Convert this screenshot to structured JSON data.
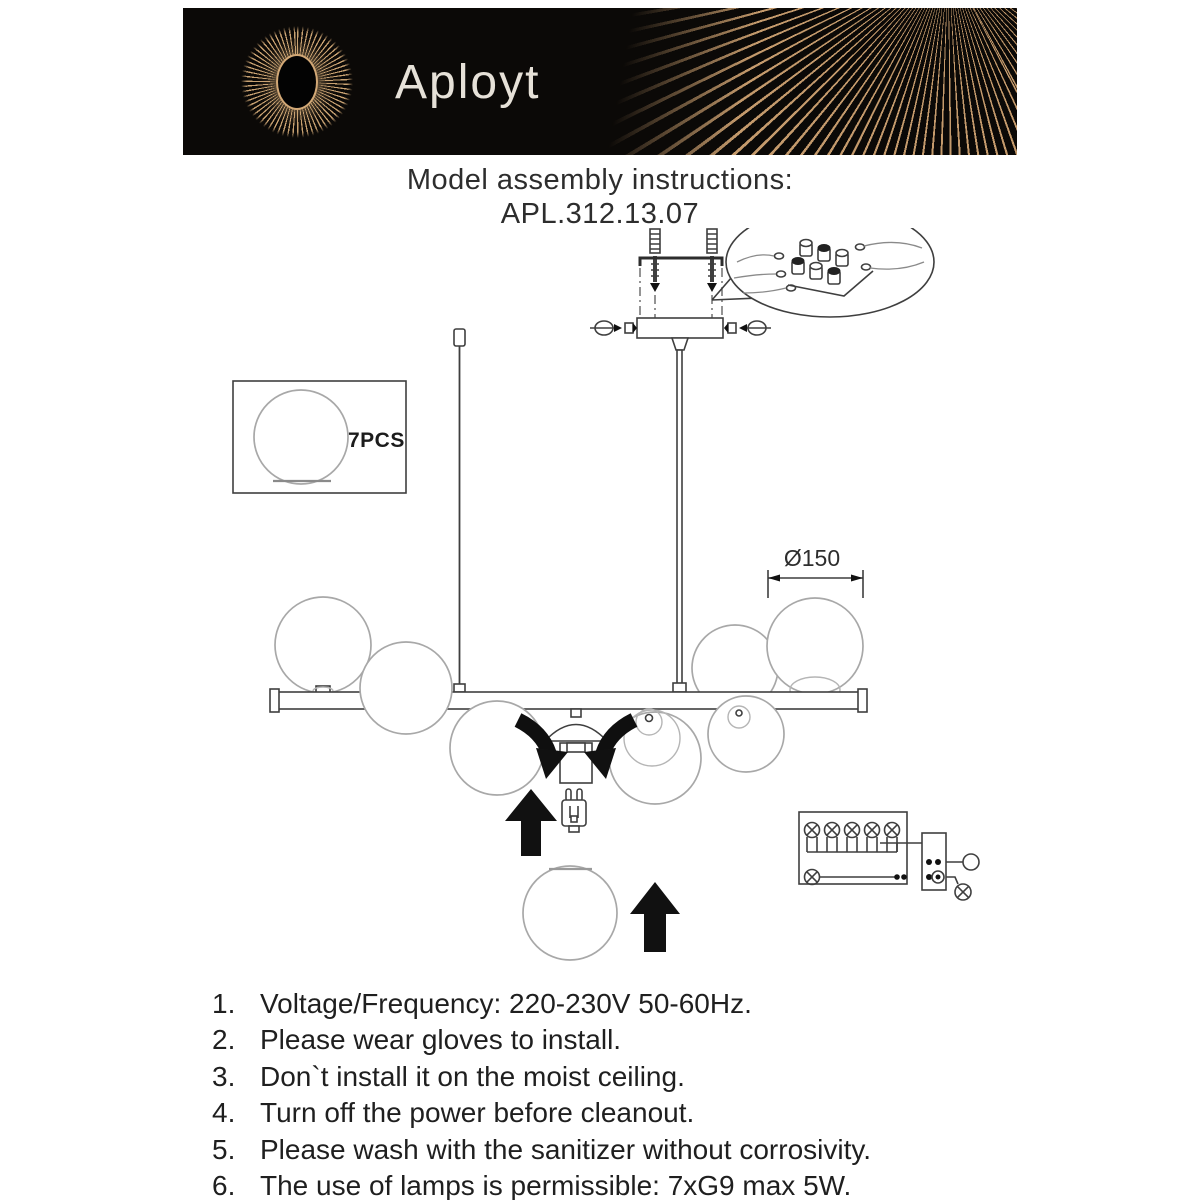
{
  "brand": {
    "name": "Aployt"
  },
  "title": {
    "heading": "Model assembly instructions:",
    "model": "APL.312.13.07"
  },
  "diagram": {
    "parts_box": {
      "label": "7PCS"
    },
    "dimension": {
      "label": "Ø150"
    }
  },
  "instructions": {
    "items": [
      {
        "num": "1.",
        "text": "Voltage/Frequency: 220-230V 50-60Hz."
      },
      {
        "num": "2.",
        "text": "Please wear gloves to install."
      },
      {
        "num": "3.",
        "text": "Don`t install it on the moist ceiling."
      },
      {
        "num": "4.",
        "text": "Turn off the power before cleanout."
      },
      {
        "num": "5.",
        "text": "Please wash with the sanitizer without corrosivity."
      },
      {
        "num": "6.",
        "text": "The use of lamps is permissible: 7xG9 max 5W."
      }
    ]
  },
  "colors": {
    "banner_background": "#0b0907",
    "brand_gold": "#c9a272",
    "drawing_line": "#3f3f3f",
    "sphere_line": "#a8a8a8",
    "text": "#1f1f1f"
  }
}
